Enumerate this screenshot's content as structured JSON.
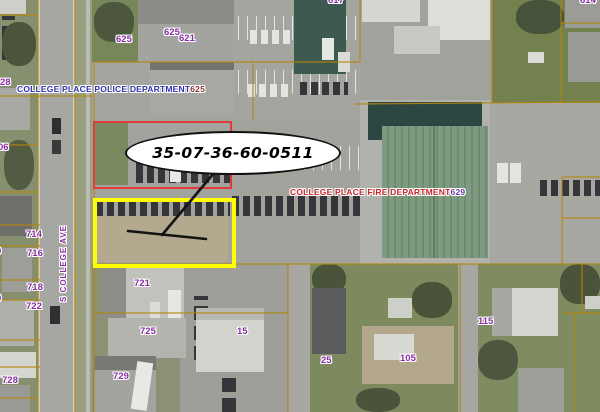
{
  "map": {
    "callout": {
      "parcel_id": "35-07-36-60-0511"
    },
    "police_label": {
      "name": "COLLEGE PLACE POLICE DEPARTMENT",
      "number": "625"
    },
    "fire_label": {
      "name": "COLLEGE PLACE FIRE DEPARTMENT",
      "number": "629"
    },
    "street_label": "S COLLEGE AVE",
    "parcel_numbers": [
      {
        "text": "617",
        "x": 328,
        "y": -4
      },
      {
        "text": "614",
        "x": 580,
        "y": -4
      },
      {
        "text": "625",
        "x": 116,
        "y": 35
      },
      {
        "text": "625",
        "x": 164,
        "y": 28
      },
      {
        "text": "621",
        "x": 179,
        "y": 34
      },
      {
        "text": "28",
        "x": 0,
        "y": 78
      },
      {
        "text": "06",
        "x": -2,
        "y": 143
      },
      {
        "text": "714",
        "x": 26,
        "y": 230
      },
      {
        "text": "716",
        "x": 27,
        "y": 249
      },
      {
        "text": "0",
        "x": -4,
        "y": 247
      },
      {
        "text": "718",
        "x": 27,
        "y": 283
      },
      {
        "text": "722",
        "x": 26,
        "y": 302
      },
      {
        "text": "0",
        "x": -4,
        "y": 294
      },
      {
        "text": "728",
        "x": 2,
        "y": 376
      },
      {
        "text": "721",
        "x": 134,
        "y": 279
      },
      {
        "text": "725",
        "x": 140,
        "y": 327
      },
      {
        "text": "729",
        "x": 113,
        "y": 372
      },
      {
        "text": "15",
        "x": 237,
        "y": 327
      },
      {
        "text": "25",
        "x": 321,
        "y": 356
      },
      {
        "text": "105",
        "x": 400,
        "y": 354
      },
      {
        "text": "115",
        "x": 478,
        "y": 317
      }
    ],
    "colors": {
      "parcel-line": "#b4860f",
      "label-purple": "#8a2fa3",
      "police-blue": "#3232b0",
      "police-number-red": "#8c3a3a",
      "fire-red": "#c5272d",
      "fire-number-purple": "#6a3fa5",
      "highlight-red": "#e03b3b",
      "highlight-yellow": "#ffff00",
      "leader-black": "#141414"
    }
  }
}
